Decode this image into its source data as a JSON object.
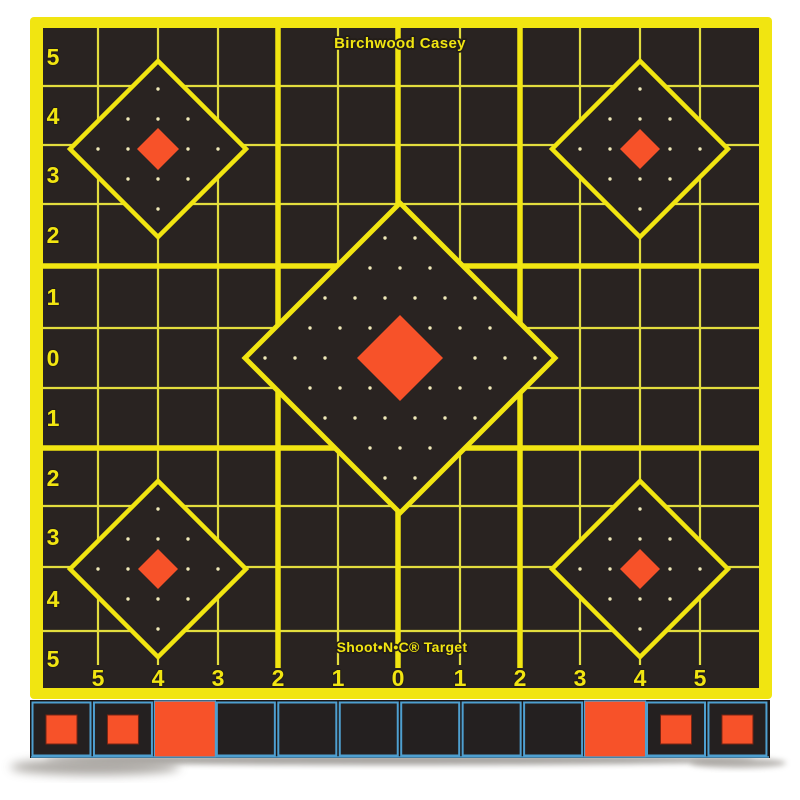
{
  "brand": {
    "title": "Birchwood Casey",
    "footer": "Shoot•N•C® Target"
  },
  "axes": {
    "row_labels": [
      "5",
      "4",
      "3",
      "2",
      "1",
      "0",
      "1",
      "2",
      "3",
      "4",
      "5"
    ],
    "col_labels": [
      "5",
      "4",
      "3",
      "2",
      "1",
      "0",
      "1",
      "2",
      "3",
      "4",
      "5"
    ]
  },
  "colors": {
    "grid_yellow": "#f1e511",
    "grid_yellow_thin": "#e2dd3e",
    "bullseye_orange": "#f75229",
    "target_black": "#292321",
    "dot_pale": "#efe9b8",
    "paster_border_blue": "#4e9fd0",
    "paster_black": "#242020",
    "strip_background": "#1b1716",
    "shadow_gray": "#96928c"
  },
  "pasters": {
    "squares": [
      "inset",
      "inset",
      "solid",
      "plain",
      "plain",
      "plain",
      "plain",
      "plain",
      "plain",
      "solid",
      "inset",
      "inset"
    ]
  }
}
